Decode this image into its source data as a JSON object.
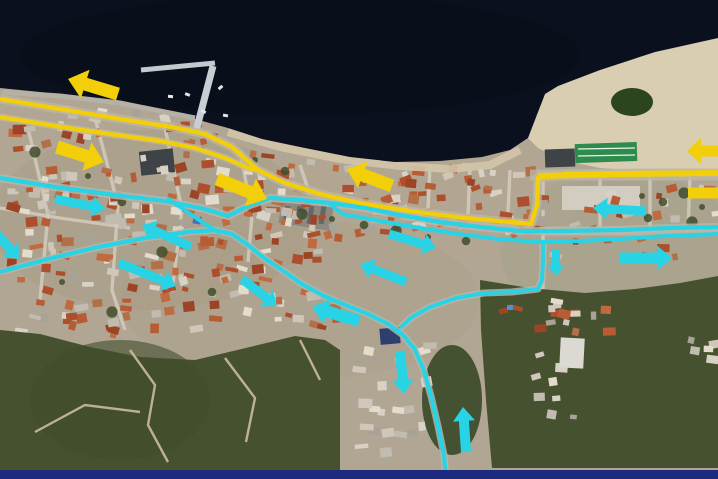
{
  "scene": {
    "description": "aerial satellite photo of a coastal town annotated with yellow and cyan traffic-route arrows",
    "bottom_border_color": "#1c2b80"
  },
  "palette": {
    "sea": "#0b101e",
    "land": "#b1a694",
    "land_shade": "#a3987f",
    "beach": "#d9cdb2",
    "coast_sand": "#d3c5a8",
    "vegetation": "#46522f",
    "vegetation_dark": "#3f4d2b",
    "road": "#bdb6a8",
    "street": "#d2cbbd",
    "dirt_path": "#cabd9f",
    "yellow": "#f2cf08",
    "cyan": "#29d3e6",
    "pier": "#c9ced4",
    "pond": "#2c451f",
    "sports_field": "#2e8a4d",
    "dark_lot": "#3e4347",
    "navy_bar": "#1c2b80"
  },
  "geometry": {
    "sea": [
      [
        0,
        0
      ],
      [
        718,
        0
      ],
      [
        718,
        38
      ],
      [
        655,
        52
      ],
      [
        600,
        70
      ],
      [
        558,
        86
      ],
      [
        545,
        94
      ],
      [
        538,
        112
      ],
      [
        528,
        138
      ],
      [
        510,
        150
      ],
      [
        482,
        157
      ],
      [
        440,
        161
      ],
      [
        395,
        162
      ],
      [
        350,
        157
      ],
      [
        305,
        148
      ],
      [
        262,
        139
      ],
      [
        228,
        128
      ],
      [
        195,
        119
      ],
      [
        150,
        108
      ],
      [
        95,
        99
      ],
      [
        40,
        92
      ],
      [
        0,
        88
      ]
    ],
    "beach": [
      [
        545,
        94
      ],
      [
        558,
        86
      ],
      [
        600,
        70
      ],
      [
        655,
        52
      ],
      [
        718,
        38
      ],
      [
        718,
        172
      ],
      [
        655,
        172
      ],
      [
        600,
        168
      ],
      [
        562,
        160
      ],
      [
        538,
        148
      ],
      [
        528,
        138
      ],
      [
        538,
        112
      ]
    ],
    "coast_sand": [
      [
        228,
        132
      ],
      [
        280,
        147
      ],
      [
        340,
        159
      ],
      [
        400,
        166
      ],
      [
        450,
        169
      ],
      [
        490,
        165
      ],
      [
        520,
        150
      ]
    ],
    "vegetation": [
      [
        [
          0,
          330
        ],
        [
          40,
          334
        ],
        [
          90,
          347
        ],
        [
          140,
          357
        ],
        [
          195,
          360
        ],
        [
          250,
          347
        ],
        [
          295,
          336
        ],
        [
          325,
          340
        ],
        [
          340,
          350
        ],
        [
          340,
          470
        ],
        [
          0,
          470
        ]
      ],
      [
        [
          480,
          280
        ],
        [
          530,
          288
        ],
        [
          585,
          293
        ],
        [
          635,
          289
        ],
        [
          680,
          283
        ],
        [
          718,
          276
        ],
        [
          718,
          468
        ],
        [
          492,
          468
        ],
        [
          486,
          400
        ],
        [
          481,
          330
        ]
      ]
    ],
    "pier": {
      "arm_main": [
        [
          196,
          131
        ],
        [
          213,
          66
        ]
      ],
      "arm_top": [
        [
          141,
          70
        ],
        [
          215,
          63
        ]
      ],
      "quay": [
        [
          2,
          92
        ],
        [
          60,
          96
        ],
        [
          120,
          103
        ],
        [
          195,
          118
        ]
      ]
    }
  },
  "routes": {
    "yellow": [
      {
        "name": "coastal-route-upper",
        "width": 4.4,
        "points": [
          [
            0,
            99
          ],
          [
            60,
            109
          ],
          [
            120,
            119
          ],
          [
            172,
            127
          ],
          [
            205,
            134
          ],
          [
            232,
            147
          ],
          [
            258,
            170
          ],
          [
            285,
            183
          ],
          [
            320,
            194
          ],
          [
            360,
            203
          ],
          [
            410,
            211
          ],
          [
            465,
            218
          ],
          [
            510,
            222
          ],
          [
            531,
            224
          ],
          [
            537,
            205
          ],
          [
            538,
            178
          ],
          [
            565,
            174
          ],
          [
            640,
            173
          ],
          [
            718,
            173
          ]
        ]
      },
      {
        "name": "coastal-route-lower",
        "width": 4.2,
        "points": [
          [
            0,
            117
          ],
          [
            55,
            126
          ],
          [
            110,
            134
          ],
          [
            160,
            141
          ],
          [
            195,
            148
          ],
          [
            225,
            158
          ],
          [
            248,
            168
          ],
          [
            258,
            170
          ]
        ]
      },
      {
        "name": "east-highway-overlay",
        "width": 6,
        "points": [
          [
            538,
            176
          ],
          [
            620,
            174
          ],
          [
            718,
            173
          ]
        ]
      }
    ],
    "cyan": [
      {
        "name": "mid-route",
        "width": 4.2,
        "points": [
          [
            0,
            178
          ],
          [
            55,
            187
          ],
          [
            115,
            195
          ],
          [
            165,
            201
          ],
          [
            205,
            209
          ],
          [
            228,
            216
          ],
          [
            250,
            205
          ],
          [
            270,
            198
          ],
          [
            300,
            200
          ],
          [
            330,
            203
          ],
          [
            365,
            208
          ],
          [
            400,
            215
          ],
          [
            440,
            222
          ],
          [
            480,
            227
          ],
          [
            520,
            231
          ],
          [
            560,
            231
          ],
          [
            620,
            230
          ],
          [
            670,
            228
          ],
          [
            718,
            227
          ]
        ]
      },
      {
        "name": "mid-route-parallel",
        "width": 4,
        "points": [
          [
            330,
            204
          ],
          [
            342,
            214
          ],
          [
            380,
            221
          ],
          [
            420,
            228
          ],
          [
            458,
            234
          ],
          [
            498,
            239
          ],
          [
            540,
            242
          ],
          [
            580,
            241
          ],
          [
            620,
            239
          ],
          [
            665,
            236
          ],
          [
            718,
            234
          ]
        ]
      },
      {
        "name": "town-winding-route",
        "width": 4.2,
        "points": [
          [
            0,
            272
          ],
          [
            48,
            259
          ],
          [
            98,
            247
          ],
          [
            145,
            238
          ],
          [
            188,
            232
          ],
          [
            215,
            230
          ],
          [
            232,
            234
          ],
          [
            248,
            245
          ],
          [
            264,
            258
          ],
          [
            282,
            270
          ],
          [
            302,
            284
          ],
          [
            324,
            296
          ],
          [
            348,
            306
          ],
          [
            368,
            314
          ],
          [
            388,
            324
          ],
          [
            403,
            335
          ],
          [
            414,
            348
          ],
          [
            423,
            368
          ],
          [
            431,
            396
          ],
          [
            438,
            426
          ],
          [
            444,
            455
          ],
          [
            446,
            479
          ]
        ]
      },
      {
        "name": "east-loop",
        "width": 4,
        "points": [
          [
            543,
            243
          ],
          [
            543,
            262
          ],
          [
            542,
            280
          ],
          [
            538,
            289
          ],
          [
            512,
            292
          ],
          [
            484,
            293
          ],
          [
            456,
            298
          ],
          [
            430,
            307
          ],
          [
            412,
            317
          ],
          [
            400,
            328
          ]
        ]
      },
      {
        "name": "connector",
        "width": 4,
        "points": [
          [
            167,
            198
          ],
          [
            186,
            211
          ],
          [
            205,
            224
          ],
          [
            220,
            233
          ]
        ]
      }
    ]
  },
  "arrows": [
    {
      "id": "yellow-arrow-1",
      "color": "yellow",
      "direction": "west",
      "tail": [
        118,
        94
      ],
      "head": [
        68,
        79
      ],
      "w": 13,
      "hw": 30,
      "hl": 18
    },
    {
      "id": "yellow-arrow-2",
      "color": "yellow",
      "direction": "east",
      "tail": [
        57,
        147
      ],
      "head": [
        104,
        162
      ],
      "w": 13,
      "hw": 30,
      "hl": 18
    },
    {
      "id": "yellow-arrow-3",
      "color": "yellow",
      "direction": "east",
      "tail": [
        217,
        179
      ],
      "head": [
        267,
        199
      ],
      "w": 13,
      "hw": 30,
      "hl": 18
    },
    {
      "id": "yellow-arrow-4",
      "color": "yellow",
      "direction": "west",
      "tail": [
        392,
        186
      ],
      "head": [
        347,
        169
      ],
      "w": 13,
      "hw": 28,
      "hl": 17
    },
    {
      "id": "yellow-arrow-5",
      "color": "yellow",
      "direction": "west",
      "tail": [
        718,
        151
      ],
      "head": [
        687,
        151
      ],
      "w": 11,
      "hw": 26,
      "hl": 14
    },
    {
      "id": "yellow-bar-6",
      "color": "yellow",
      "direction": "west",
      "tail": [
        718,
        193
      ],
      "head": [
        688,
        193
      ],
      "w": 11,
      "hw": 11,
      "hl": 0
    },
    {
      "id": "cyan-arrow-1",
      "color": "cyan",
      "direction": "east",
      "tail": [
        55,
        199
      ],
      "head": [
        105,
        209
      ],
      "w": 9,
      "hw": 21,
      "hl": 13
    },
    {
      "id": "cyan-arrow-2",
      "color": "cyan",
      "direction": "southeast",
      "tail": [
        -3,
        234
      ],
      "head": [
        19,
        259
      ],
      "w": 9,
      "hw": 21,
      "hl": 13
    },
    {
      "id": "cyan-arrow-3",
      "color": "cyan",
      "direction": "northwest",
      "tail": [
        191,
        247
      ],
      "head": [
        142,
        225
      ],
      "w": 9,
      "hw": 21,
      "hl": 13
    },
    {
      "id": "cyan-arrow-4",
      "color": "cyan",
      "direction": "southeast",
      "tail": [
        119,
        263
      ],
      "head": [
        176,
        286
      ],
      "w": 9,
      "hw": 21,
      "hl": 13
    },
    {
      "id": "cyan-arrow-5",
      "color": "cyan",
      "direction": "southeast",
      "tail": [
        242,
        279
      ],
      "head": [
        277,
        306
      ],
      "w": 9,
      "hw": 21,
      "hl": 13
    },
    {
      "id": "cyan-arrow-6",
      "color": "cyan",
      "direction": "west",
      "tail": [
        359,
        321
      ],
      "head": [
        312,
        307
      ],
      "w": 12,
      "hw": 26,
      "hl": 16
    },
    {
      "id": "cyan-arrow-7",
      "color": "cyan",
      "direction": "northwest",
      "tail": [
        406,
        282
      ],
      "head": [
        360,
        264
      ],
      "w": 9,
      "hw": 21,
      "hl": 13
    },
    {
      "id": "cyan-arrow-8",
      "color": "cyan",
      "direction": "southeast",
      "tail": [
        389,
        234
      ],
      "head": [
        436,
        248
      ],
      "w": 9,
      "hw": 21,
      "hl": 13
    },
    {
      "id": "cyan-arrow-9",
      "color": "cyan",
      "direction": "west",
      "tail": [
        646,
        211
      ],
      "head": [
        593,
        208
      ],
      "w": 9,
      "hw": 22,
      "hl": 14
    },
    {
      "id": "cyan-arrow-10",
      "color": "cyan",
      "direction": "south",
      "tail": [
        556,
        249
      ],
      "head": [
        556,
        276
      ],
      "w": 8,
      "hw": 18,
      "hl": 11
    },
    {
      "id": "cyan-arrow-11",
      "color": "cyan",
      "direction": "east",
      "tail": [
        619,
        258
      ],
      "head": [
        672,
        258
      ],
      "w": 11,
      "hw": 25,
      "hl": 15
    },
    {
      "id": "cyan-arrow-12",
      "color": "cyan",
      "direction": "south",
      "tail": [
        400,
        351
      ],
      "head": [
        404,
        394
      ],
      "w": 10,
      "hw": 22,
      "hl": 14
    },
    {
      "id": "cyan-arrow-13",
      "color": "cyan",
      "direction": "north",
      "tail": [
        466,
        452
      ],
      "head": [
        463,
        407
      ],
      "w": 10,
      "hw": 22,
      "hl": 14
    }
  ]
}
